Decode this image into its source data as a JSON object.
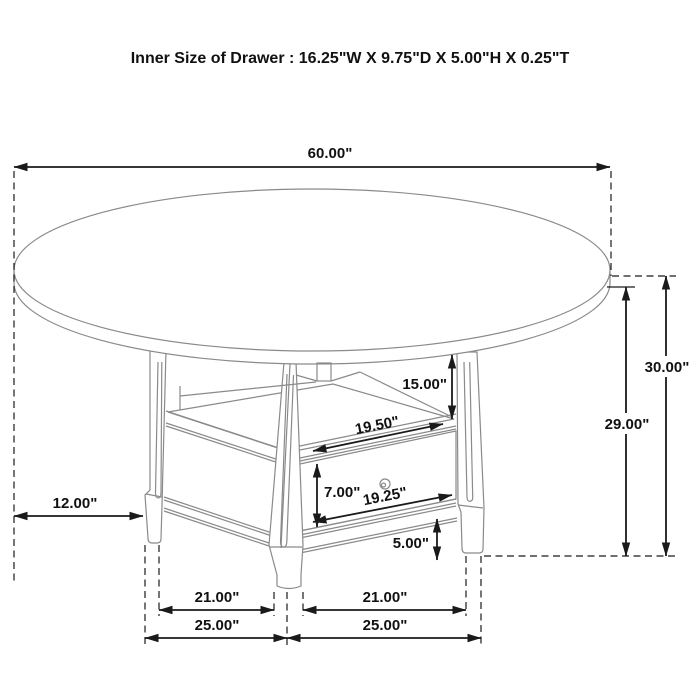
{
  "title": "Inner Size of Drawer : 16.25\"W X 9.75\"D X 5.00\"H X 0.25\"T",
  "dimensions": {
    "table_diameter": "60.00\"",
    "overall_height": "30.00\"",
    "underside_height": "29.00\"",
    "compartment_height": "15.00\"",
    "shelf_width": "19.50\"",
    "drawer_front_height": "7.00\"",
    "drawer_front_width": "19.25\"",
    "apron_height": "5.00\"",
    "top_overhang": "12.00\"",
    "leg_clear_left": "21.00\"",
    "leg_clear_right": "21.00\"",
    "leg_center_left": "25.00\"",
    "leg_center_right": "25.00\""
  },
  "colors": {
    "dimension_line": "#1a1a1a",
    "furniture_line": "#8a8a8a",
    "background": "#ffffff"
  }
}
